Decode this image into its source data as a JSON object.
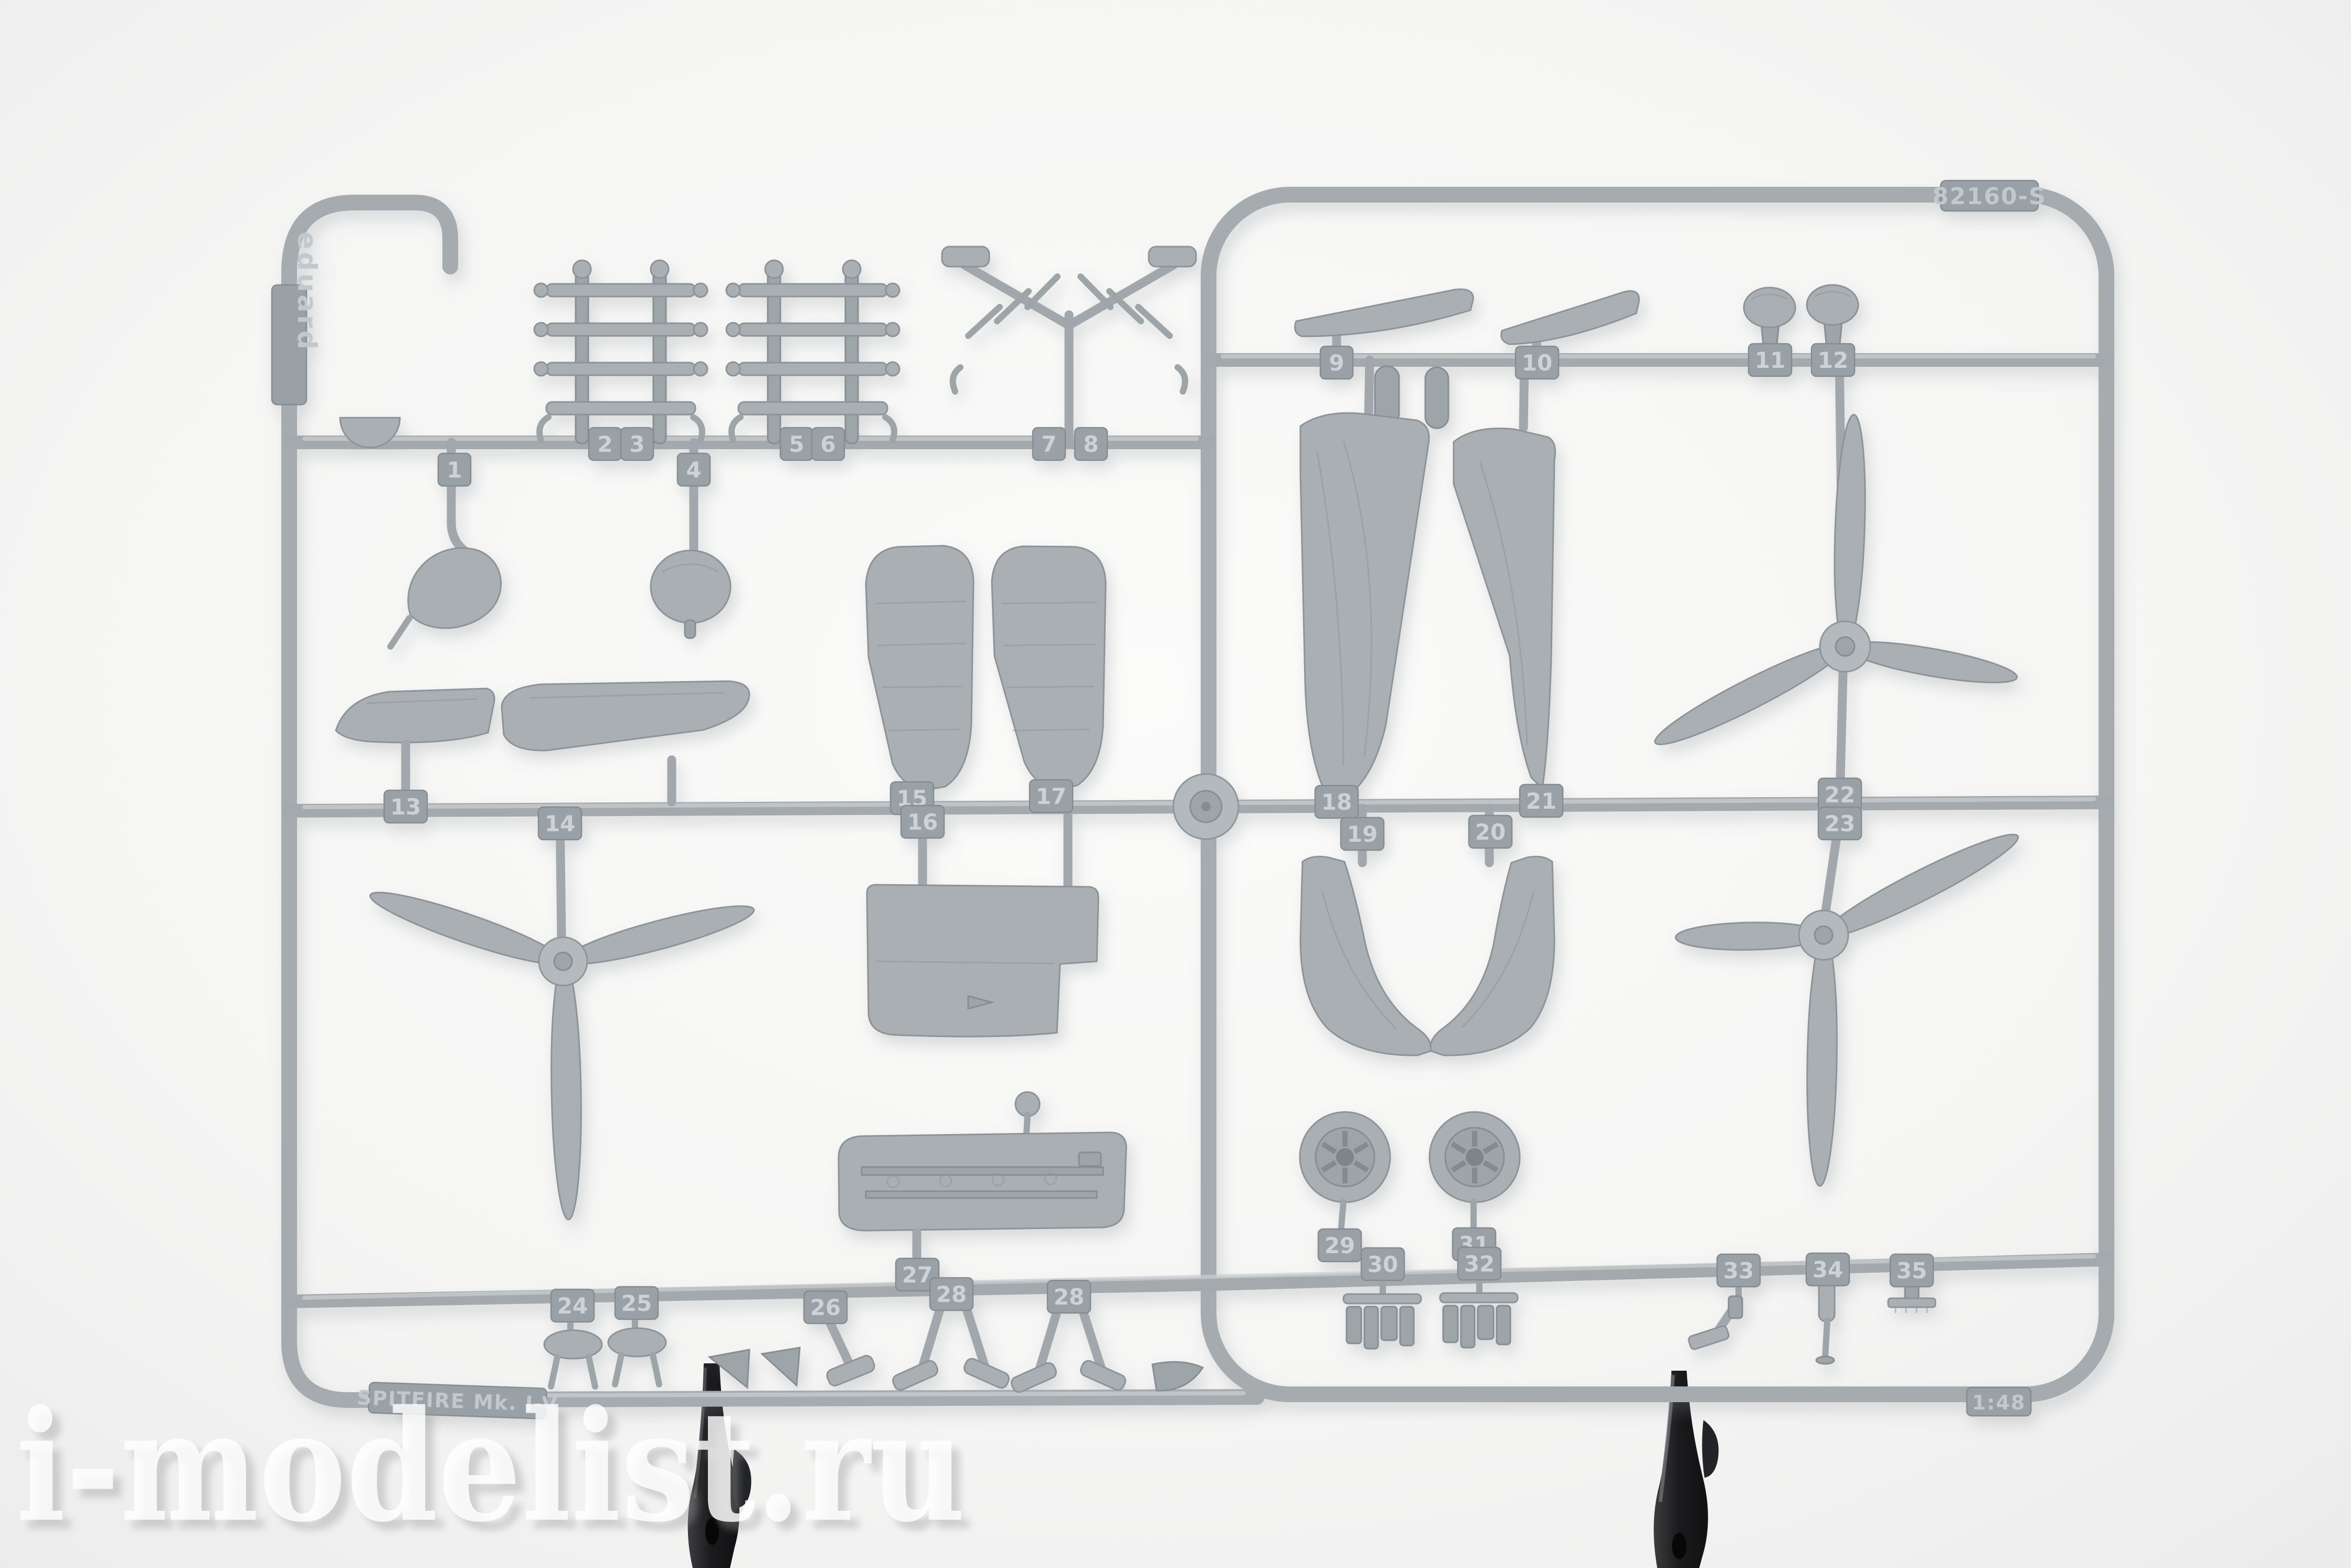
{
  "sprue": {
    "brand_tab": "eduard",
    "code_tab": "82160-S",
    "name_tab": "SPITFIRE Mk. I-V",
    "scale_tab": "1:48",
    "part_numbers": [
      "1",
      "2",
      "3",
      "4",
      "5",
      "6",
      "7",
      "8",
      "9",
      "10",
      "11",
      "12",
      "13",
      "14",
      "15",
      "16",
      "17",
      "18",
      "19",
      "20",
      "21",
      "22",
      "23",
      "24",
      "25",
      "26",
      "27",
      "28",
      "28",
      "29",
      "30",
      "31",
      "32",
      "33",
      "34",
      "35"
    ]
  },
  "watermark": {
    "text": "i-modelist.ru"
  },
  "colors": {
    "plastic": "#a5abaf",
    "plastic_light": "#c8cdd0",
    "plastic_dark": "#8d9398",
    "background": "#f5f5f4",
    "clamp": "#1e1e20"
  }
}
